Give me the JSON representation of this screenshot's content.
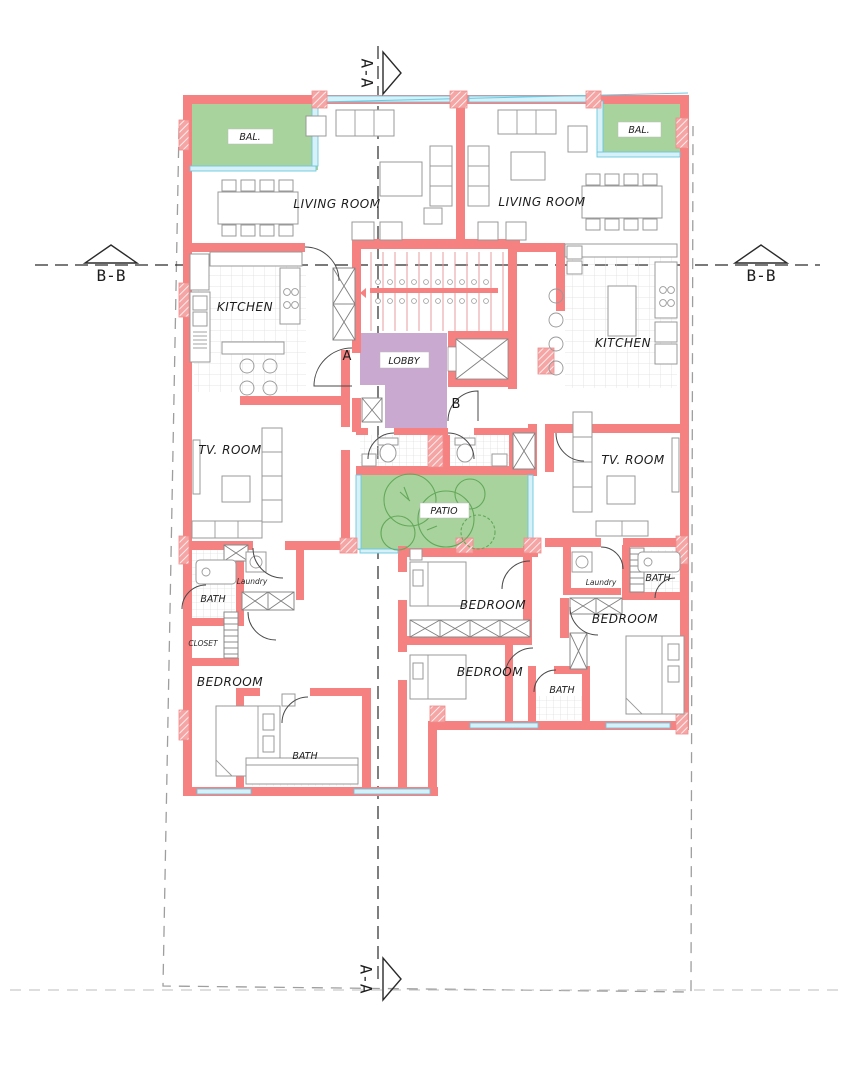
{
  "drawing": {
    "type": "architectural-floor-plan",
    "labels": {
      "balcony": "BAL.",
      "living_room": "LIVING ROOM",
      "kitchen": "KITCHEN",
      "lobby": "LOBBY",
      "tv_room": "TV. ROOM",
      "patio": "PATIO",
      "bedroom": "BEDROOM",
      "bath": "BATH",
      "closet": "CLOSET",
      "laundry": "Laundry"
    },
    "markers": {
      "section_a": "A-A",
      "section_b": "B-B",
      "door_a": "A",
      "door_b": "B"
    },
    "colors": {
      "wall": "#f58181",
      "green_area": "#a8d39d",
      "lobby_fill": "#c9a9cf",
      "window": "#6cc7df",
      "boundary": "#9e9e9e",
      "section_line": "#2a2a2a",
      "furniture": "#999999",
      "tree": "#63a85a"
    }
  }
}
